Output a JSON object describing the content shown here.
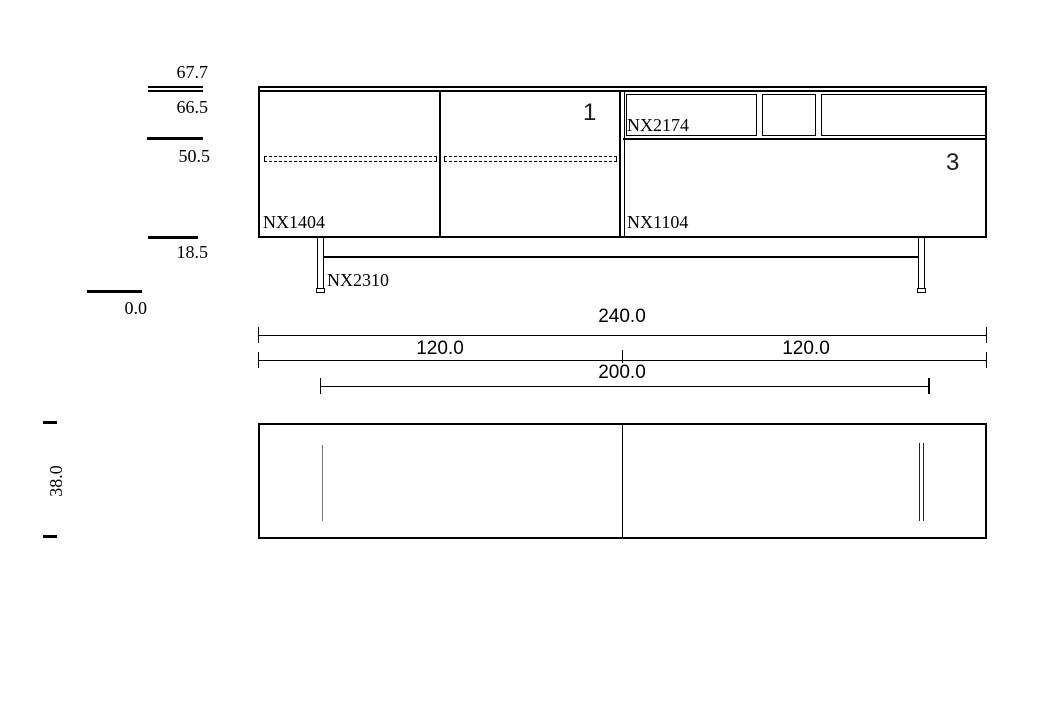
{
  "height_marks": {
    "h677": "67.7",
    "h665": "66.5",
    "h505": "50.5",
    "h185": "18.5",
    "h00": "0.0"
  },
  "parts": {
    "left_cabinet": "NX1404",
    "shelf_unit": "NX2174",
    "right_cabinet": "NX1104",
    "base_frame": "NX2310"
  },
  "positions": {
    "pos1": "1",
    "pos3": "3"
  },
  "dims": {
    "overall": "240.0",
    "left_half": "120.0",
    "right_half": "120.0",
    "base_span": "200.0",
    "depth": "38.0"
  }
}
